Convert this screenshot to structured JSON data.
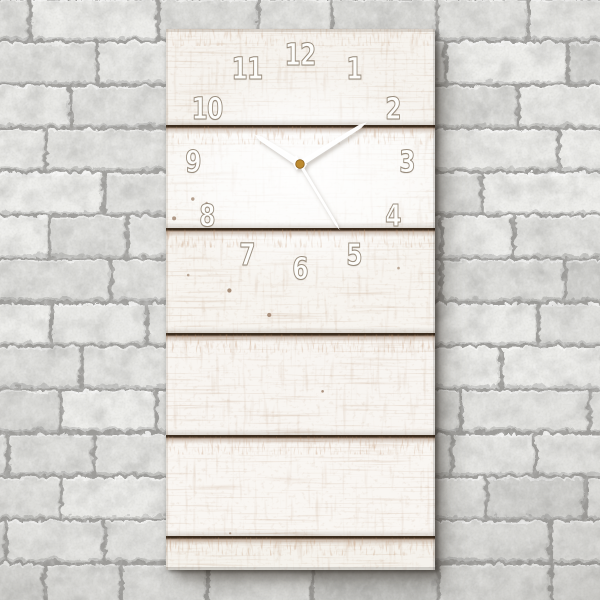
{
  "scene": {
    "type": "product photo",
    "subject": "vertical rectangular wall clock made of white weathered wooden planks, hanging on a white stone brick wall",
    "wall_colors": {
      "mortar": "#9d9c99",
      "brick_light": "#efeeec",
      "brick_dark": "#d6d5d2"
    }
  },
  "clock": {
    "numerals": [
      "12",
      "1",
      "2",
      "3",
      "4",
      "5",
      "6",
      "7",
      "8",
      "9",
      "10",
      "11"
    ],
    "numeral_fill": "#fdfdfb",
    "numeral_outline": "#998d7e",
    "wood_color": "#f8f5f0",
    "seam_color": "#2e1d0e",
    "center_cap_color": "#bd8a2f",
    "hands": {
      "color": "#ffffff",
      "hour_deg": 303,
      "minute_deg": 58,
      "second_deg": 149,
      "time_shown_approx": "10:10:25"
    }
  }
}
